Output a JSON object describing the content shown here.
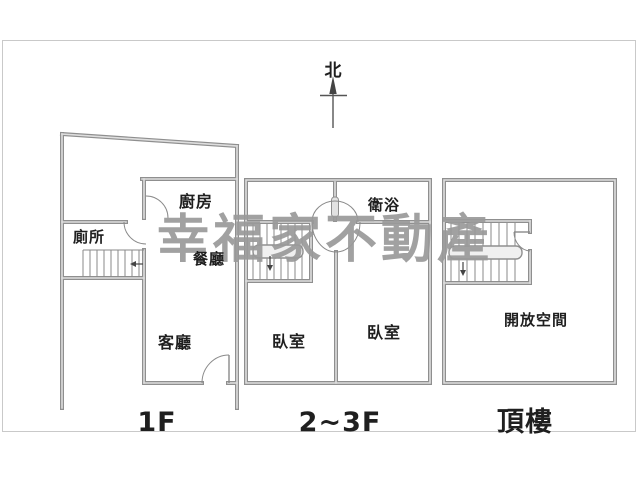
{
  "title": "房屋平面圖",
  "compass": {
    "north_label": "北"
  },
  "watermark": {
    "text": "幸福家不動產",
    "color": "#9a9a9a"
  },
  "units": [
    {
      "floor_label": "1F",
      "rooms": [
        {
          "name": "廚房"
        },
        {
          "name": "廁所"
        },
        {
          "name": "餐廳"
        },
        {
          "name": "客廳"
        }
      ]
    },
    {
      "floor_label": "2~3F",
      "rooms": [
        {
          "name": "衛浴"
        },
        {
          "name": "臥室"
        },
        {
          "name": "臥室"
        }
      ]
    },
    {
      "floor_label": "頂樓",
      "rooms": [
        {
          "name": "開放空間"
        }
      ]
    }
  ],
  "colors": {
    "wall": "#8f8f8f",
    "label": "#1f1f1f",
    "border": "#c9c9c9"
  }
}
